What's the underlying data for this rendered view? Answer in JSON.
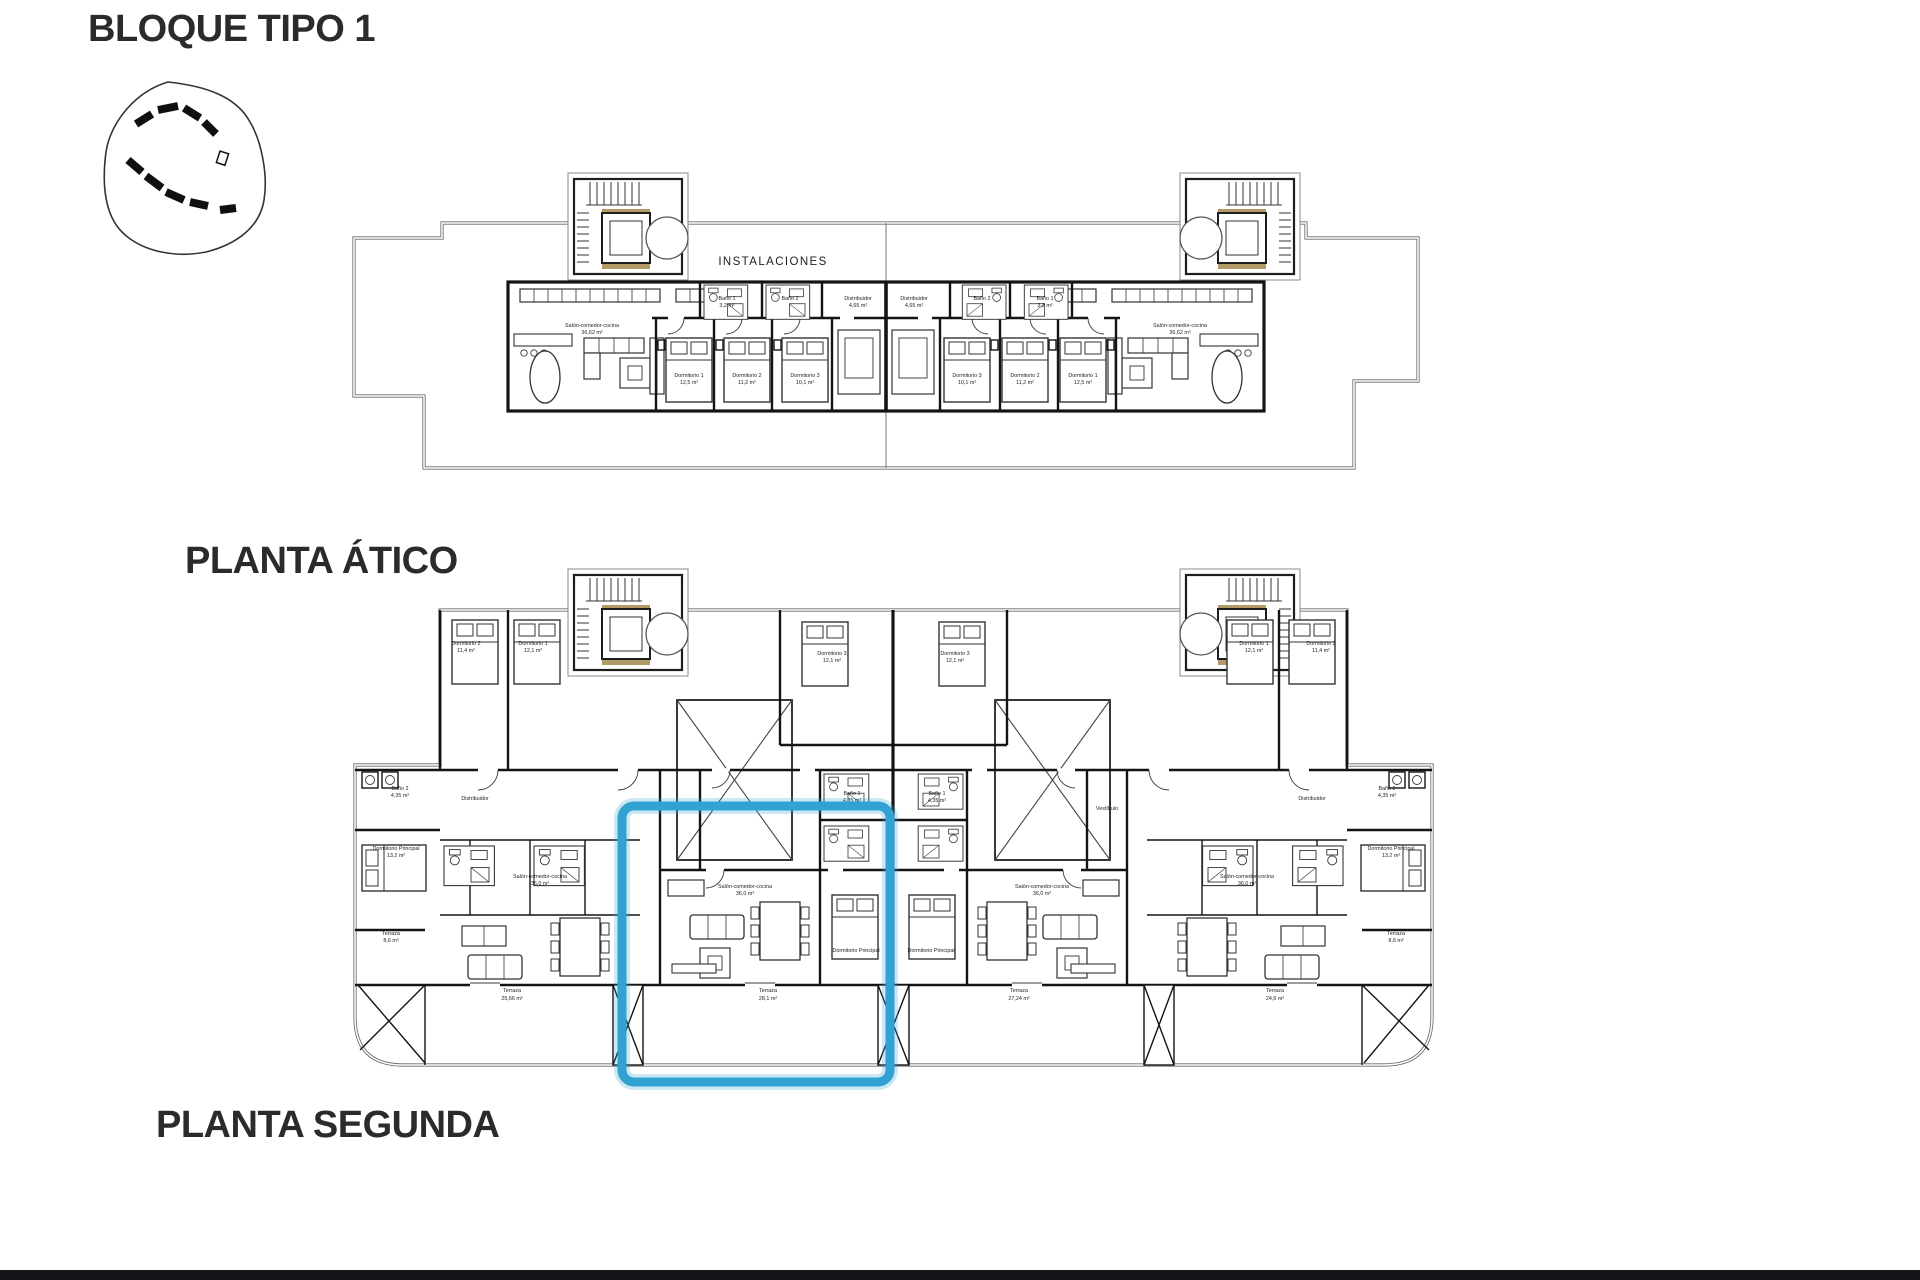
{
  "page": {
    "title": "BLOQUE TIPO 1",
    "background_color": "#ffffff",
    "footer_bar_color": "#14141a"
  },
  "colors": {
    "highlight_blue": "#32a2d2",
    "wall_black": "#141414",
    "outline_gray": "#6b6b6b",
    "elevator_tan": "#b29a66"
  },
  "plans": {
    "atico": {
      "label": "PLANTA ÁTICO",
      "labels": [
        "INSTALACIONES",
        "Salón-comedor-cocina",
        "36,62 m²",
        "Dormitorio 1",
        "12,5 m²",
        "Dormitorio 2",
        "11,2 m²",
        "Dormitorio 3",
        "10,1 m²",
        "Distribuidor",
        "Baño 1",
        "Baño 2",
        "4,65 m²",
        "3,2 m²"
      ]
    },
    "segunda": {
      "label": "PLANTA SEGUNDA",
      "labels": [
        "Dormitorio 1",
        "Dormitorio 2",
        "Dormitorio 3",
        "Dormitorio Principal",
        "Baño 1",
        "Baño 2",
        "Distribuidor",
        "Vestíbulo",
        "Salón-comedor-cocina",
        "Terraza",
        "25,66 m²",
        "28,1 m²",
        "27,24 m²",
        "24,6 m²",
        "8,6 m²",
        "13,2 m²",
        "4,35 m²",
        "12,1 m²",
        "11,4 m²",
        "36,0 m²"
      ]
    }
  }
}
